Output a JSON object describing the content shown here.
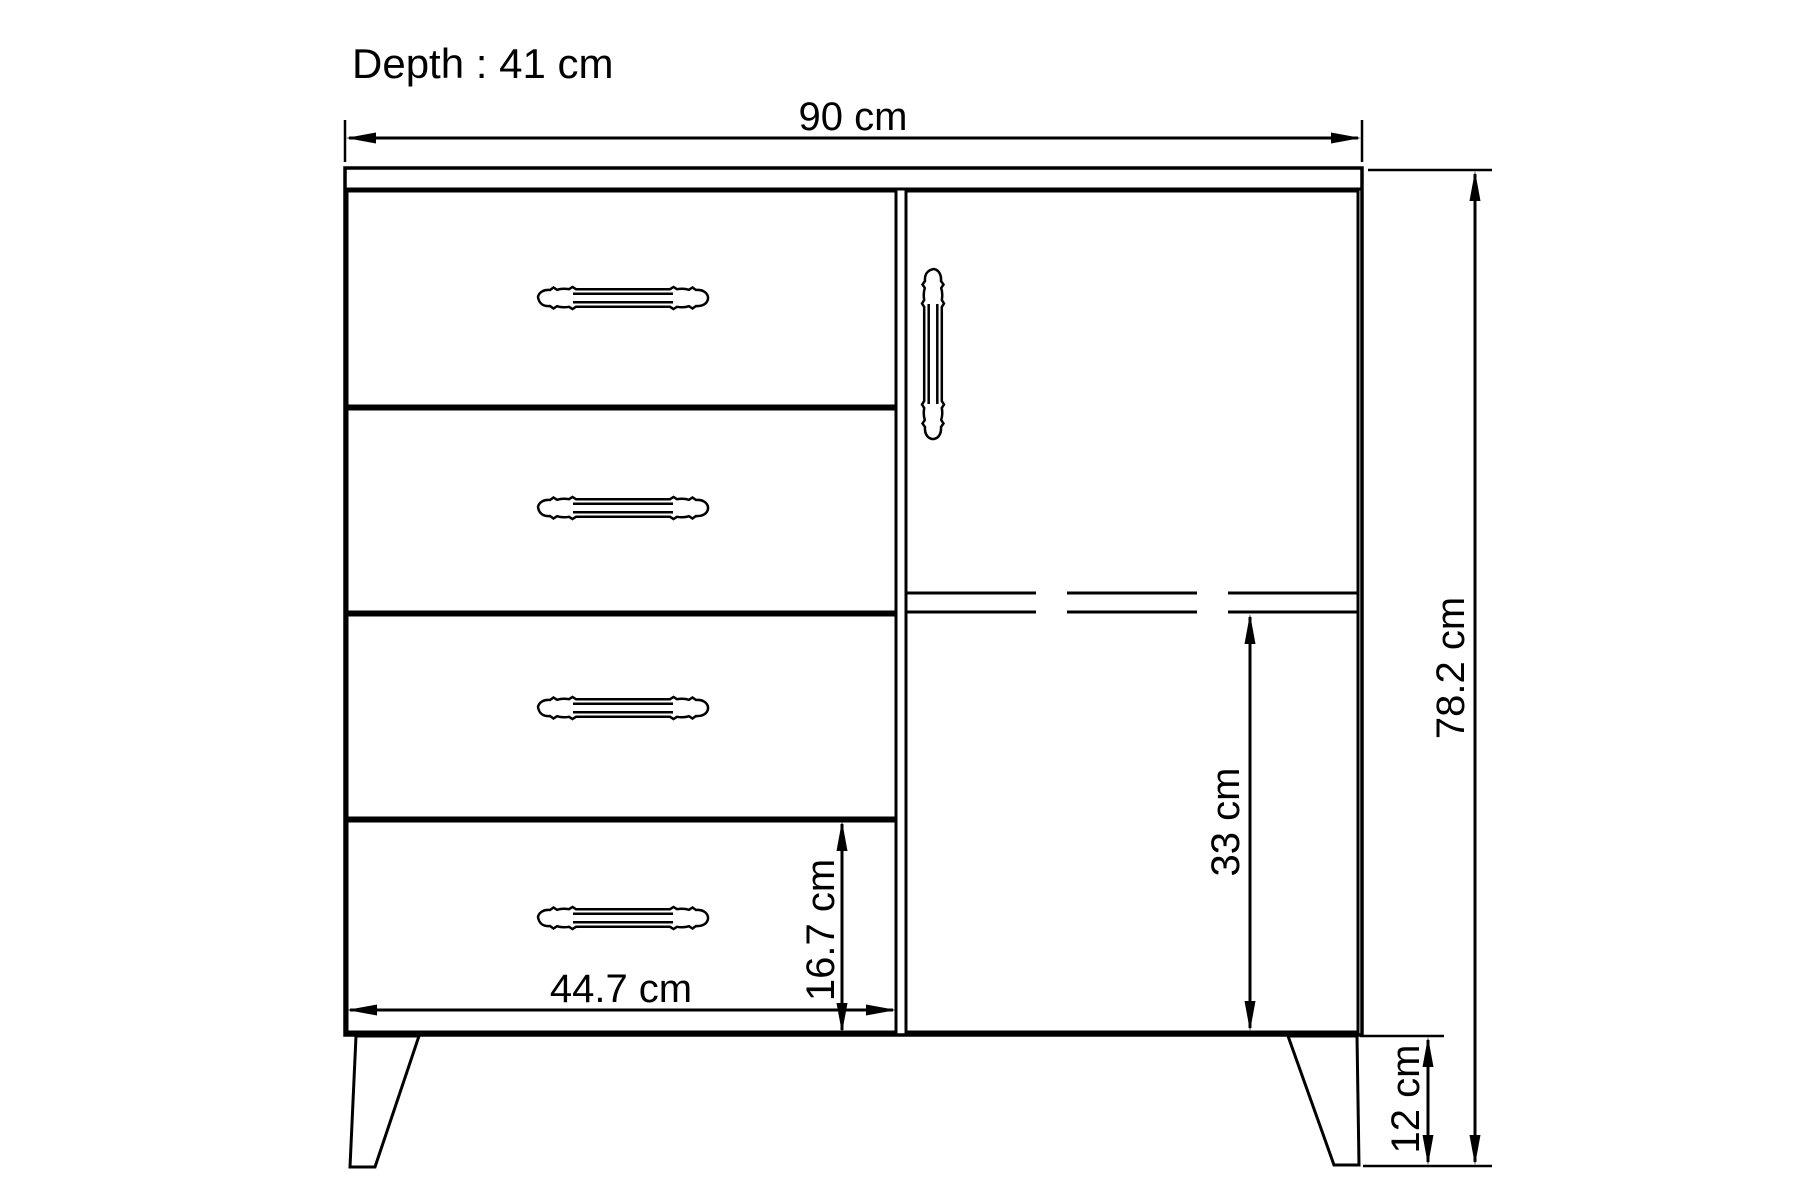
{
  "drawing": {
    "depth_label": "Depth : 41 cm",
    "width_label": "90 cm",
    "height_label": "78.2 cm",
    "drawer_width_label": "44.7 cm",
    "drawer_height_label": "16.7 cm",
    "door_inner_label": "33 cm",
    "leg_label": "12 cm",
    "line_color": "#000000",
    "bg_color": "#ffffff",
    "drawer_count": "4",
    "door_count": "1"
  }
}
